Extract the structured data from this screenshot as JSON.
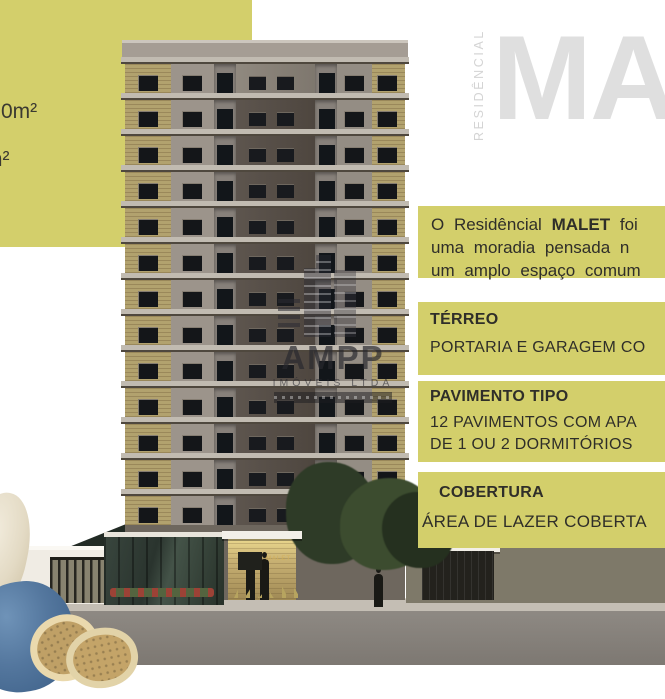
{
  "accent_olive": "#d3cf6b",
  "left_panel": {
    "area_fragment_1": "0m²",
    "area_fragment_2": "m²"
  },
  "brand": {
    "vertical_label": "RESIDÊNCIAL",
    "big_word_fragment": "MA",
    "ghost_color": "#dfdfdf"
  },
  "intro_box": {
    "line1_pre": "O Residêncial",
    "line1_brand": "MALET",
    "line1_post": "foi",
    "line2": "uma moradia pensada n",
    "line3": "um amplo espaço comum"
  },
  "sections": {
    "terreo": {
      "title": "TÉRREO",
      "line1": "PORTARIA E GARAGEM CO"
    },
    "pavimento": {
      "title": "PAVIMENTO TIPO",
      "line1": "12 PAVIMENTOS COM APA",
      "line2": "DE 1 OU 2 DORMITÓRIOS"
    },
    "cobertura": {
      "title": "COBERTURA",
      "line1": "ÁREA DE LAZER COBERTA"
    }
  },
  "watermark": {
    "name": "AMPP",
    "subtitle": "IMÓVEIS LTDA"
  },
  "building": {
    "floors_rendered": 13,
    "facade_sign": "MALET"
  }
}
